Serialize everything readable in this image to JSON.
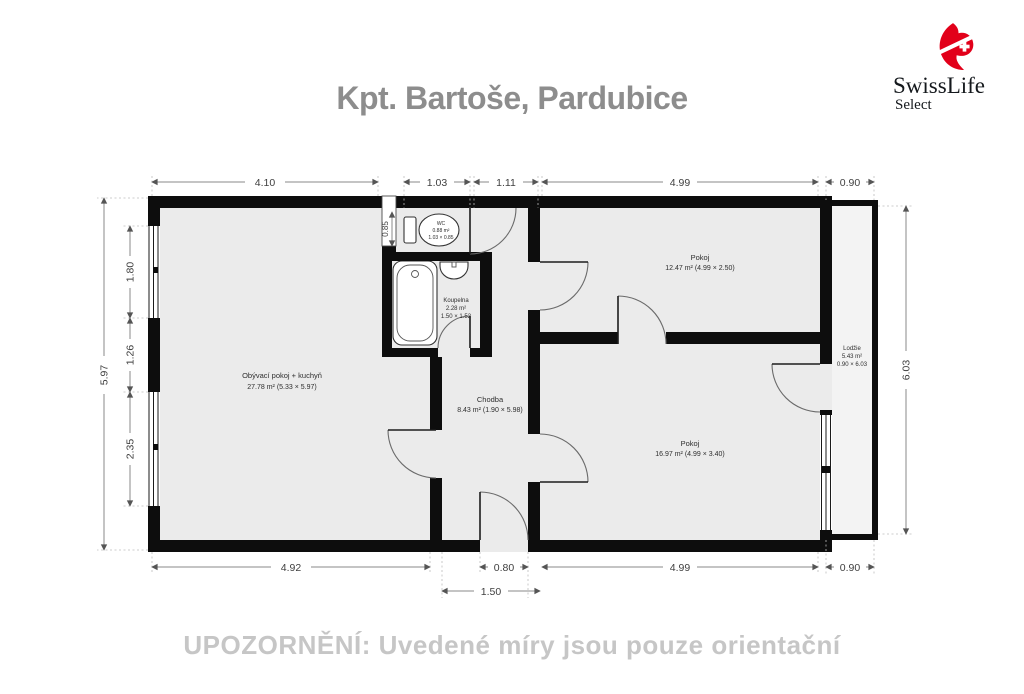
{
  "header": {
    "title": "Kpt. Bartoše, Pardubice"
  },
  "logo": {
    "brand": "SwissLife",
    "sub": "Select"
  },
  "notice": "UPOZORNĚNÍ: Uvedené míry jsou pouze orientační",
  "colors": {
    "accent_red": "#e2001a",
    "wall": "#0d0d0d",
    "room_fill": "#ebebeb",
    "title_gray": "#8d8d8d",
    "notice_gray": "#c6c6c6"
  },
  "plan": {
    "rooms": {
      "living": {
        "name": "Obývací pokoj + kuchyň",
        "area": "27.78 m² (5.33 × 5.97)"
      },
      "hall": {
        "name": "Chodba",
        "area": "8.43 m² (1.90 × 5.98)"
      },
      "bathroom": {
        "name": "Koupelna",
        "area": "2.28 m²",
        "dims": "1.50 × 1.52"
      },
      "wc": {
        "name": "WC",
        "area": "0.88 m²",
        "dims": "1.03 × 0.85"
      },
      "room_top": {
        "name": "Pokoj",
        "area": "12.47 m² (4.99 × 2.50)"
      },
      "room_bottom": {
        "name": "Pokoj",
        "area": "16.97 m² (4.99 × 3.40)"
      },
      "loggia": {
        "name": "Lodžie",
        "area": "5.43 m²",
        "dims": "0.90 × 6.03"
      }
    },
    "dims": {
      "top": [
        "4.10",
        "1.03",
        "1.11",
        "4.99",
        "0.90"
      ],
      "bottom": [
        "4.92",
        "0.80",
        "4.99",
        "0.90"
      ],
      "bottom2": [
        "1.50"
      ],
      "left_overall": "5.97",
      "left": [
        "1.80",
        "1.26",
        "2.35"
      ],
      "right": "6.03",
      "niche": "0.85"
    }
  }
}
